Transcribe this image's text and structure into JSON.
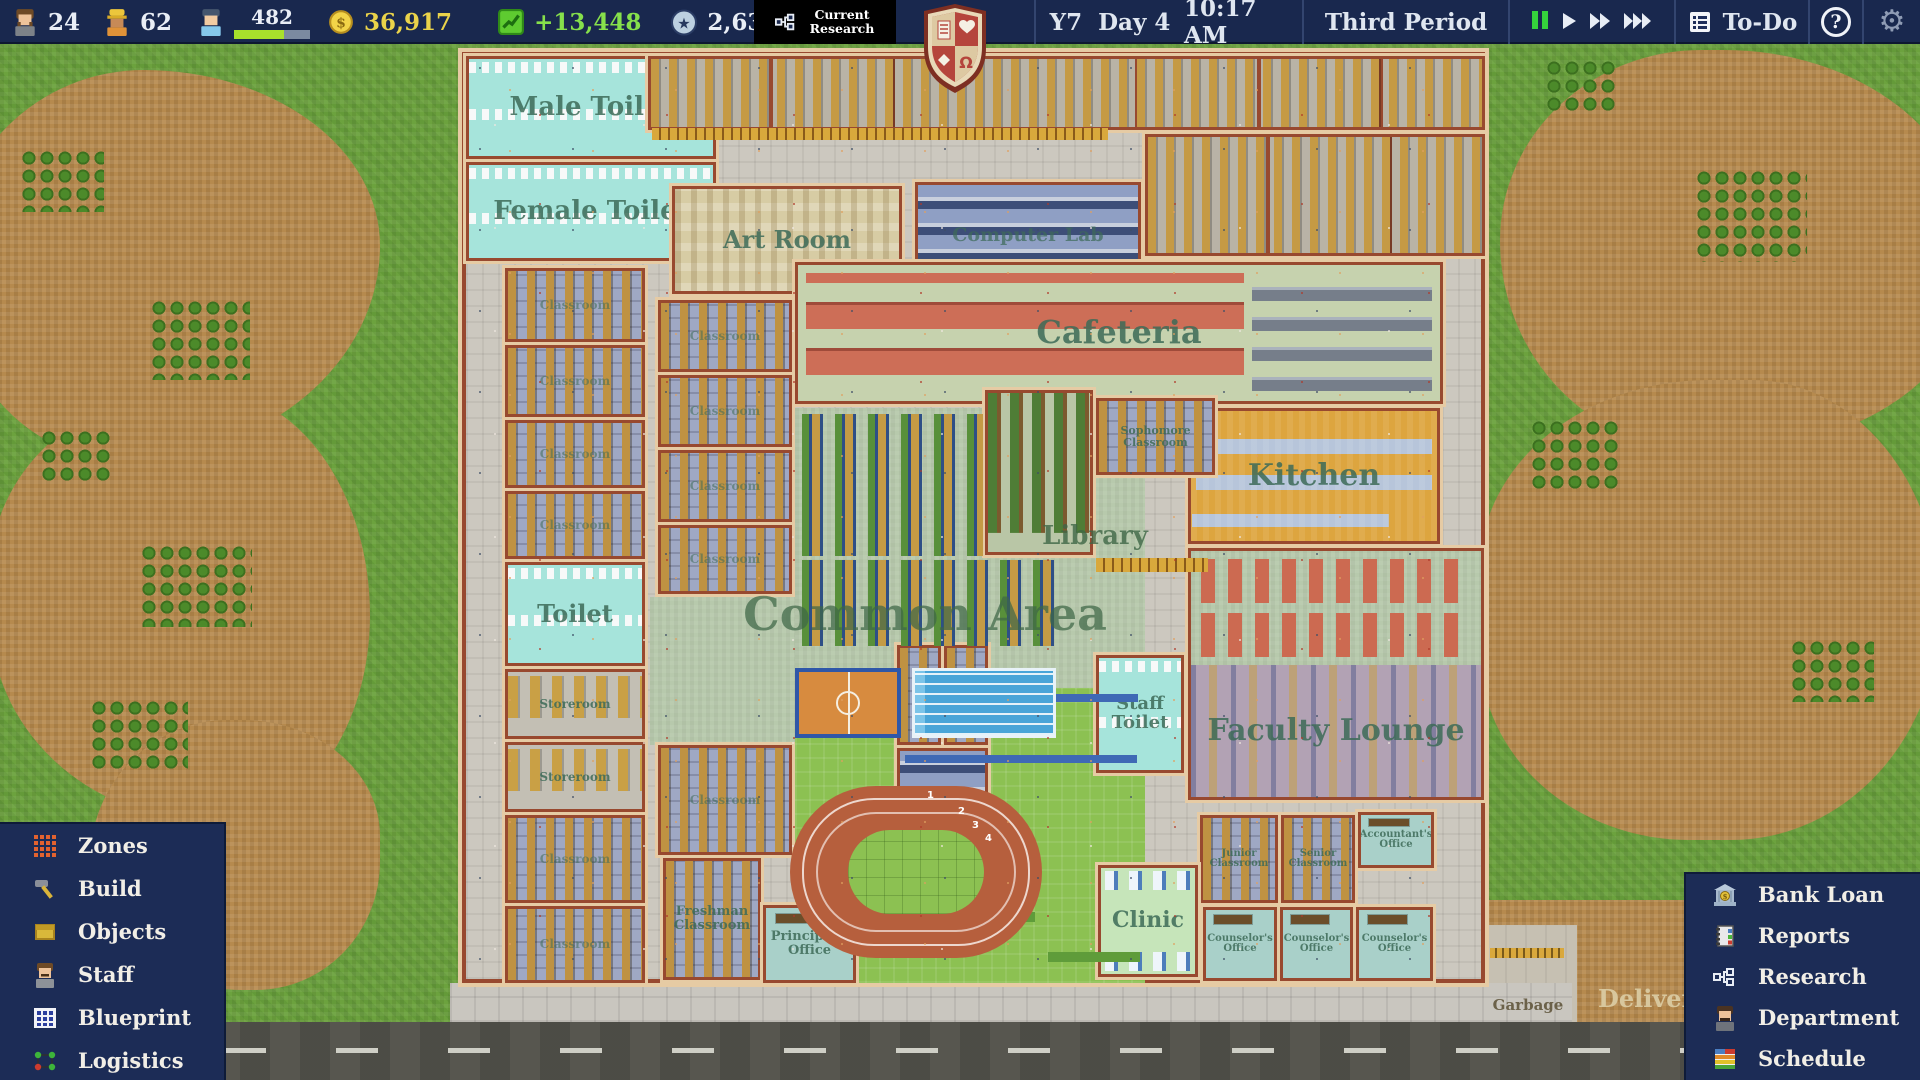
{
  "top_bar": {
    "teachers": "24",
    "workers": "62",
    "students": "482",
    "money": "36,917",
    "profit": "+13,448",
    "prestige": "2,635",
    "research_label": "Current Research",
    "year": "Y7",
    "day": "Day 4",
    "time": "10:17 AM",
    "period": "Third Period",
    "todo": "To-Do",
    "help": "?"
  },
  "left_menu": {
    "items": [
      {
        "id": "zones",
        "label": "Zones"
      },
      {
        "id": "build",
        "label": "Build"
      },
      {
        "id": "objects",
        "label": "Objects"
      },
      {
        "id": "staff",
        "label": "Staff"
      },
      {
        "id": "blueprint",
        "label": "Blueprint"
      },
      {
        "id": "logistics",
        "label": "Logistics"
      }
    ]
  },
  "right_menu": {
    "items": [
      {
        "id": "bank-loan",
        "label": "Bank Loan"
      },
      {
        "id": "reports",
        "label": "Reports"
      },
      {
        "id": "research",
        "label": "Research"
      },
      {
        "id": "department",
        "label": "Department"
      },
      {
        "id": "schedule",
        "label": "Schedule"
      }
    ]
  },
  "map": {
    "rooms": {
      "male_toilet": "Male Toilet",
      "female_toilet": "Female Toilet",
      "art_room": "Art Room",
      "computer_lab": "Computer Lab",
      "cafeteria": "Cafeteria",
      "kitchen": "Kitchen",
      "library": "Library",
      "common_area": "Common Area",
      "staff_toilet": "Staff Toilet",
      "faculty_lounge": "Faculty Lounge",
      "toilet": "Toilet",
      "classroom": "Classroom",
      "sophomore_classroom": "Sophomore Classroom",
      "freshman_classroom": "Freshman Classroom",
      "junior_classroom": "Junior Classroom",
      "senior_classroom": "Senior Classroom",
      "storeroom": "Storeroom",
      "principals_office": "Principal's Office",
      "clinic": "Clinic",
      "counselors_office": "Counselor's Office",
      "accountants_office": "Accountant's Office"
    },
    "zones": {
      "garbage": "Garbage",
      "delivery": "Delivery"
    },
    "track_lanes": [
      "1",
      "2",
      "3",
      "4"
    ]
  },
  "colors": {
    "panel_navy": "#1c2c56",
    "money_yellow": "#ead34a",
    "profit_green": "#86e04b",
    "pause_green": "#35d23c",
    "crest_red": "#b5453c"
  }
}
